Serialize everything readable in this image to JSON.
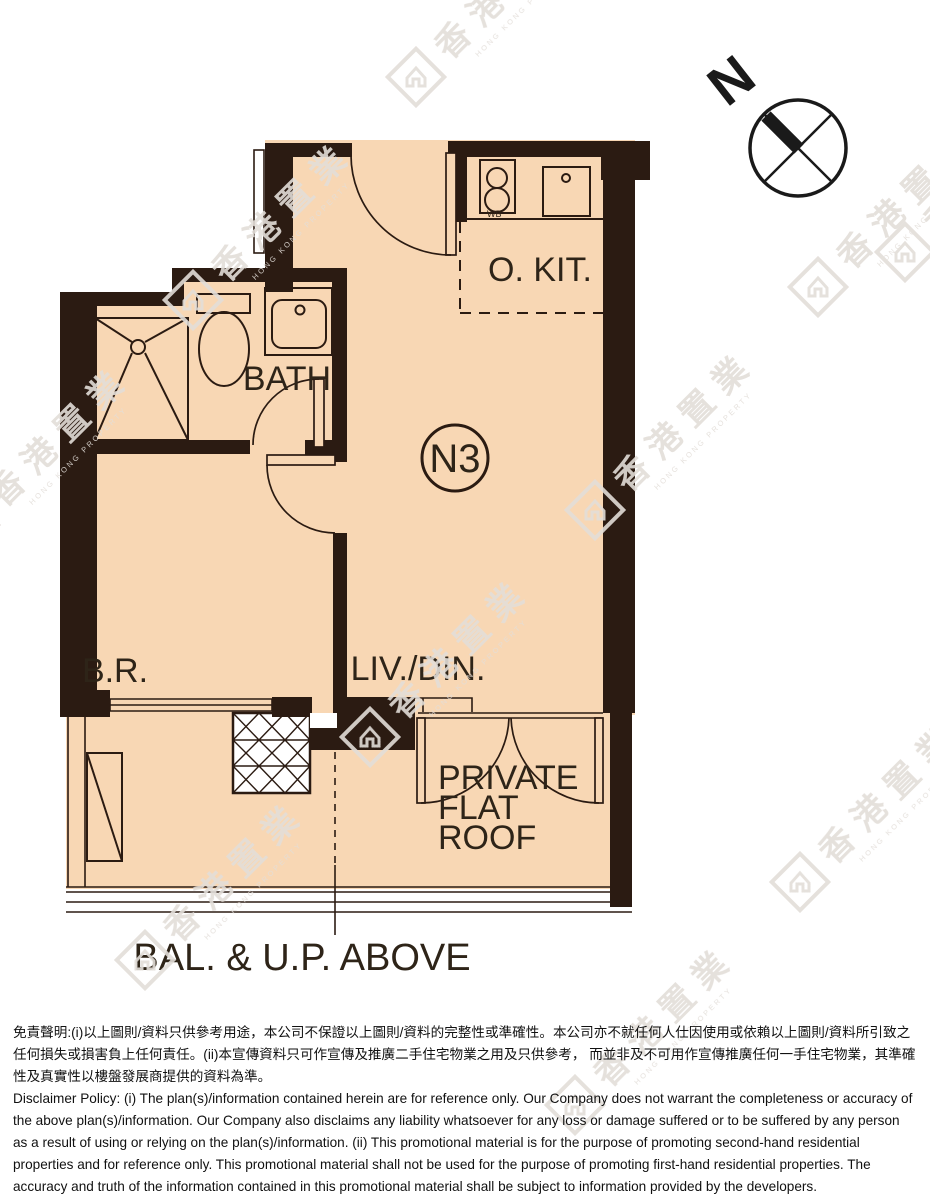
{
  "compass": {
    "label": "N"
  },
  "plan": {
    "unit_label": "N3",
    "rooms": {
      "kitchen": "O. KIT.",
      "bath": "BATH",
      "bedroom": "B.R.",
      "living": "LIV./DIN."
    },
    "flat_roof": [
      "PRIVATE",
      "FLAT",
      "ROOF"
    ],
    "annotation_bal": "BAL. & U.P. ABOVE",
    "hob_note": "WB"
  },
  "watermark": {
    "cjk": [
      "香",
      "港",
      "置",
      "業"
    ],
    "latin": "HONG KONG PROPERTY"
  },
  "disclaimer": {
    "zh": "免責聲明:(i)以上圖則/資料只供參考用途，本公司不保證以上圖則/資料的完整性或準確性。本公司亦不就任何人仕因使用或依賴以上圖則/資料所引致之任何損失或損害負上任何責任。(ii)本宣傳資料只可作宣傳及推廣二手住宅物業之用及只供參考， 而並非及不可用作宣傳推廣任何一手住宅物業，其準確性及真實性以樓盤發展商提供的資料為準。",
    "en": "Disclaimer Policy: (i) The plan(s)/information contained herein are for reference only. Our Company does not warrant the completeness or accuracy of the above plan(s)/information. Our Company also disclaims any liability whatsoever for any loss or damage suffered or to be suffered by any person as a result of using or relying on the plan(s)/information. (ii) This promotional material is for the purpose of promoting second-hand residential properties and for reference only. This promotional material shall not be used for the purpose of promoting first-hand residential properties. The accuracy and truth of the information contained in this promotional material shall be subject to information provided by the developers."
  },
  "colors": {
    "floor": "#f8d7b4",
    "wall": "#2b1b12",
    "line": "#2b1b12",
    "label_text": "#2e2418",
    "watermark": "#e3ded9",
    "disclaimer_text": "#111111"
  }
}
